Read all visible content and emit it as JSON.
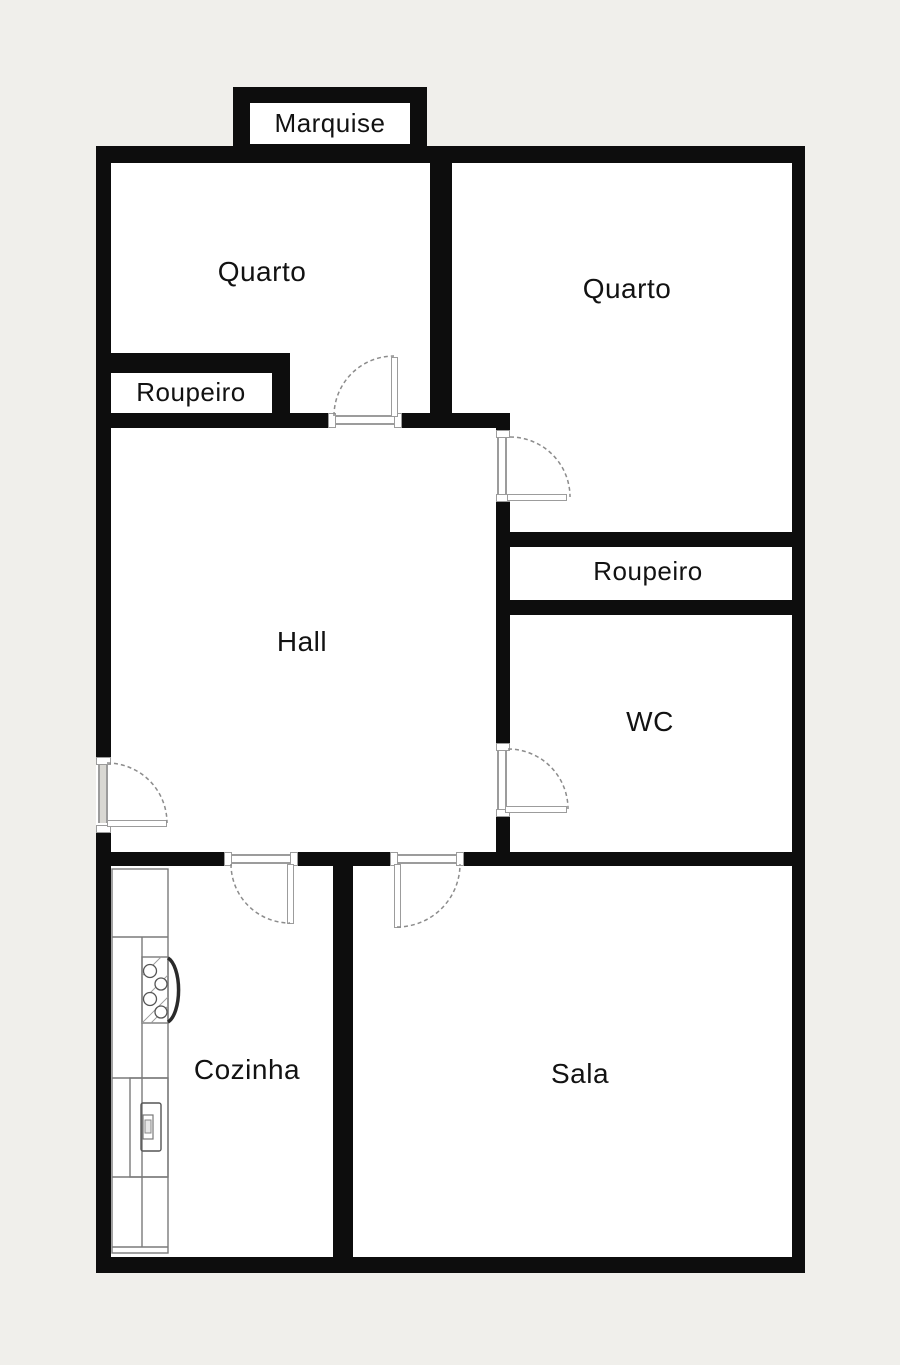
{
  "palette": {
    "background": "#f0efeb",
    "wall": "#0d0d0d",
    "floor": "#ffffff",
    "door_line": "#9c9c9c",
    "arc": "#8c8c8c",
    "label": "#121212"
  },
  "labels": {
    "marquise": "Marquise",
    "quarto_left": "Quarto",
    "quarto_right": "Quarto",
    "roupeiro_left": "Roupeiro",
    "roupeiro_right": "Roupeiro",
    "hall": "Hall",
    "wc": "WC",
    "cozinha": "Cozinha",
    "sala": "Sala"
  }
}
